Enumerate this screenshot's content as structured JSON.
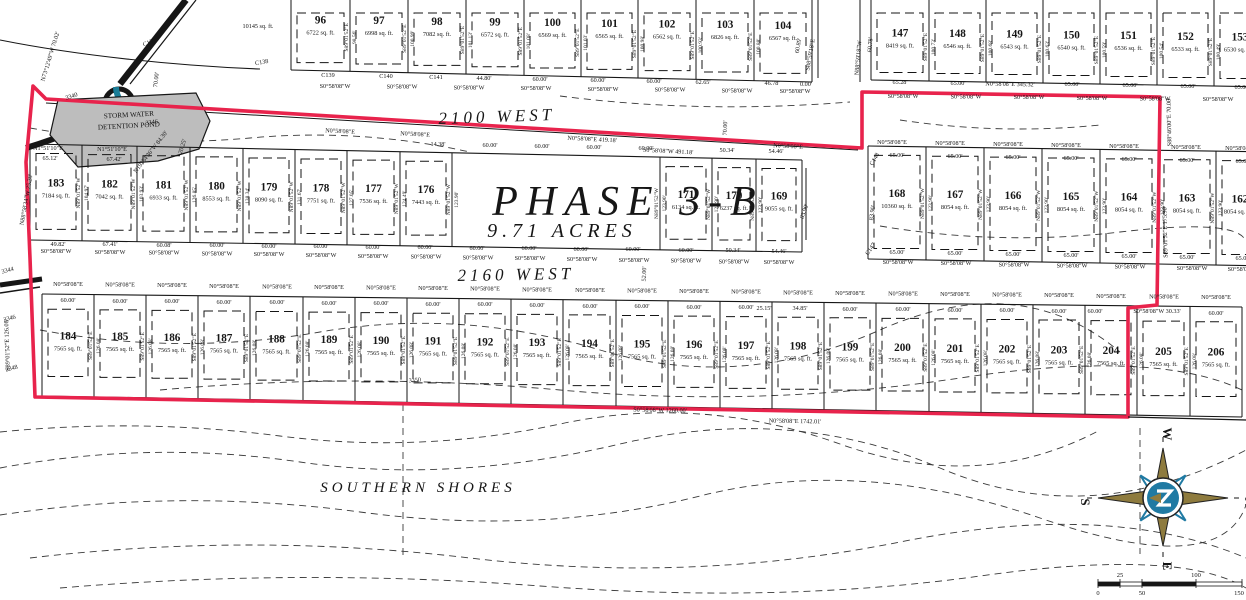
{
  "meta": {
    "width": 1246,
    "height": 600
  },
  "colors": {
    "paper": "#ffffff",
    "ink": "#161616",
    "boundary_red": "#e8234c",
    "pond_gray": "#bdbdbd",
    "teal": "#1b7d97",
    "compass_gold": "#8e7b3e",
    "compass_blue": "#1f7aa3"
  },
  "title": {
    "phase": "PHASE 3-B",
    "acres": "9.71 ACRES"
  },
  "streets": [
    {
      "name": "2100 WEST",
      "x": 497,
      "y": 122,
      "size": 17,
      "rot": -2
    },
    {
      "name": "2160 WEST",
      "x": 516,
      "y": 280,
      "size": 17,
      "rot": -1
    },
    {
      "name": "SOUTHERN SHORES",
      "x": 418,
      "y": 492,
      "size": 15,
      "rot": 0
    }
  ],
  "pond": {
    "line1": "STORM WATER",
    "line2": "DETENTION POND"
  },
  "compass": {
    "top": "W",
    "right": "N",
    "bottom": "E",
    "left": "S"
  },
  "scale_bar": {
    "top_labels": [
      {
        "t": "25",
        "x": 1120
      },
      {
        "t": "100",
        "x": 1196
      }
    ],
    "bottom_labels": [
      {
        "t": "0",
        "x": 1098
      },
      {
        "t": "50",
        "x": 1142
      },
      {
        "t": "150",
        "x": 1239
      }
    ]
  },
  "boundary": {
    "points": [
      [
        33,
        86
      ],
      [
        46,
        99
      ],
      [
        862,
        148
      ],
      [
        862,
        92
      ],
      [
        1160,
        97
      ],
      [
        1157,
        305
      ],
      [
        1128,
        308
      ],
      [
        1128,
        417
      ],
      [
        35,
        397
      ],
      [
        30,
        258
      ],
      [
        26,
        162
      ],
      [
        33,
        86
      ]
    ]
  },
  "strips": [
    {
      "id": "block-96-104",
      "cut_top": true,
      "num_y": 23,
      "seps": [
        291,
        350,
        408,
        466,
        524,
        581,
        638,
        696,
        754,
        812
      ],
      "yt": [
        0,
        0
      ],
      "yb": [
        70,
        82
      ],
      "lots": [
        [
          "96",
          "6722 sq. ft."
        ],
        [
          "97",
          "6998 sq. ft."
        ],
        [
          "98",
          "7082 sq. ft."
        ],
        [
          "99",
          "6572 sq. ft."
        ],
        [
          "100",
          "6569 sq. ft."
        ],
        [
          "101",
          "6565 sq. ft."
        ],
        [
          "102",
          "6562 sq. ft."
        ],
        [
          "103",
          "6826 sq. ft."
        ],
        [
          "104",
          "6567 sq. ft."
        ]
      ],
      "bearing": "S89°01'52\"E",
      "depths": [
        "",
        "98.56'",
        "100.99'",
        "101.13'",
        "101.08'",
        "101.03'",
        "100.98'",
        "100.93'",
        "100.88'",
        ""
      ]
    },
    {
      "id": "block-147-153",
      "cut_top": true,
      "num_y": 36,
      "seps": [
        871,
        929,
        986,
        1043,
        1100,
        1157,
        1214,
        1271
      ],
      "yt": [
        0,
        0
      ],
      "yb": [
        80,
        87
      ],
      "lots": [
        [
          "147",
          "8419 sq. ft."
        ],
        [
          "148",
          "6546 sq. ft."
        ],
        [
          "149",
          "6543 sq. ft."
        ],
        [
          "150",
          "6540 sq. ft."
        ],
        [
          "151",
          "6536 sq. ft."
        ],
        [
          "152",
          "6533 sq. ft."
        ],
        [
          "153",
          "6530 sq. ft."
        ]
      ],
      "bearing": "S89°01'52\"E",
      "depths": [
        "",
        "100.73'",
        "100.68'",
        "100.63'",
        "100.59'",
        "100.54'",
        "100.49'",
        ""
      ]
    },
    {
      "id": "block-183-169",
      "seps": [
        30,
        82,
        137,
        190,
        243,
        295,
        347,
        400,
        452,
        504,
        556,
        608,
        660,
        712,
        756,
        802
      ],
      "yt": [
        144,
        160
      ],
      "yb": [
        240,
        252
      ],
      "skip_seps": [
        9,
        10,
        11
      ],
      "lots": [
        [
          "183",
          "7184 sq. ft."
        ],
        [
          "182",
          "7042 sq. ft."
        ],
        [
          "181",
          "6933 sq. ft."
        ],
        [
          "180",
          "8553 sq. ft."
        ],
        [
          "179",
          "8090 sq. ft."
        ],
        [
          "178",
          "7751 sq. ft."
        ],
        [
          "177",
          "7536 sq. ft."
        ],
        [
          "176",
          "7443 sq. ft."
        ],
        [
          "175",
          null
        ],
        [
          "174",
          null
        ],
        [
          "173",
          null
        ],
        [
          "172",
          null
        ],
        [
          "171",
          "6134 sq. ft."
        ],
        [
          "170",
          "6237 sq. ft."
        ],
        [
          "169",
          "9055 sq. ft."
        ]
      ],
      "bearing": "N89°01'52\"W",
      "depths": [
        "",
        "104.97'",
        "103.93'",
        "126.85'",
        "138.34'",
        "131.67'",
        "127.05'",
        "124.49'",
        "123.90'",
        "",
        "",
        "",
        "123.90'",
        "123.90'",
        "123.90'",
        ""
      ]
    },
    {
      "id": "block-168-162",
      "seps": [
        868,
        926,
        984,
        1042,
        1100,
        1158,
        1216,
        1274
      ],
      "yt": [
        146,
        152
      ],
      "yb": [
        259,
        266
      ],
      "lots": [
        [
          "168",
          "10360 sq. ft."
        ],
        [
          "167",
          "8054 sq. ft."
        ],
        [
          "166",
          "8054 sq. ft."
        ],
        [
          "165",
          "8054 sq. ft."
        ],
        [
          "164",
          "8054 sq. ft."
        ],
        [
          "163",
          "8054 sq. ft."
        ],
        [
          "162",
          "8054 sq. ft."
        ]
      ],
      "bearing": "N89°01'52\"W",
      "depths": [
        "",
        "123.90'",
        "123.90'",
        "123.90'",
        "123.90'",
        "123.90'",
        "123.90'",
        ""
      ]
    },
    {
      "id": "block-184-206",
      "dash_inset": [
        15,
        20
      ],
      "seps": [
        42,
        94,
        146,
        198,
        250,
        303,
        355,
        407,
        459,
        511,
        563,
        616,
        668,
        720,
        772,
        824,
        876,
        929,
        981,
        1033,
        1085,
        1137,
        1190,
        1242
      ],
      "yt": [
        294,
        307
      ],
      "yb": [
        396,
        417
      ],
      "lots": [
        [
          "184",
          "7565 sq. ft."
        ],
        [
          "185",
          "7565 sq. ft."
        ],
        [
          "186",
          "7565 sq. ft."
        ],
        [
          "187",
          "7565 sq. ft."
        ],
        [
          "188",
          "7565 sq. ft."
        ],
        [
          "189",
          "7565 sq. ft."
        ],
        [
          "190",
          "7565 sq. ft."
        ],
        [
          "191",
          "7565 sq. ft."
        ],
        [
          "192",
          "7565 sq. ft."
        ],
        [
          "193",
          "7565 sq. ft."
        ],
        [
          "194",
          "7565 sq. ft."
        ],
        [
          "195",
          "7565 sq. ft."
        ],
        [
          "196",
          "7565 sq. ft."
        ],
        [
          "197",
          "7565 sq. ft."
        ],
        [
          "198",
          "7565 sq. ft."
        ],
        [
          "199",
          "7565 sq. ft."
        ],
        [
          "200",
          "7565 sq. ft."
        ],
        [
          "201",
          "7565 sq. ft."
        ],
        [
          "202",
          "7565 sq. ft."
        ],
        [
          "203",
          "7565 sq. ft."
        ],
        [
          "204",
          "7565 sq. ft."
        ],
        [
          "205",
          "7565 sq. ft."
        ],
        [
          "206",
          "7565 sq. ft."
        ]
      ],
      "bearing": "S89°01'52\"E",
      "depths": [
        "",
        "126.08'",
        "126.08'",
        "126.08'",
        "126.08'",
        "126.08'",
        "126.08'",
        "126.08'",
        "126.08'",
        "126.08'",
        "126.08'",
        "126.08'",
        "126.08'",
        "126.08'",
        "126.08'",
        "126.08'",
        "126.08'",
        "126.08'",
        "126.08'",
        "126.08'",
        "126.08'",
        "126.08'",
        "126.08'",
        ""
      ]
    }
  ],
  "bearing_rows": [
    {
      "t": "S0°58'08\"W",
      "y1": 88,
      "y2": 93,
      "xs": [
        335,
        402,
        469,
        536,
        603,
        670,
        737,
        795
      ]
    },
    {
      "t": "S0°58'08\"W",
      "y1": 98,
      "y2": 101,
      "xs": [
        903,
        966,
        1029,
        1092,
        1155,
        1218
      ]
    },
    {
      "t": "N0°58'08\"E",
      "y1": 144,
      "y2": 150,
      "xs": [
        892,
        950,
        1008,
        1066,
        1124,
        1186,
        1240
      ]
    },
    {
      "t": "S0°58'08\"W",
      "y1": 253,
      "y2": 264,
      "xs": [
        56,
        110,
        164,
        217,
        269,
        321,
        373,
        426,
        478,
        530,
        582,
        634,
        686,
        734,
        779
      ]
    },
    {
      "t": "S0°58'08\"W",
      "y1": 264,
      "y2": 271,
      "xs": [
        898,
        956,
        1014,
        1072,
        1130,
        1192,
        1243
      ]
    },
    {
      "t": "N0°58'08\"E",
      "y1": 286,
      "y2": 299,
      "xs": [
        68,
        120,
        172,
        224,
        277,
        329,
        381,
        433,
        485,
        537,
        590,
        642,
        694,
        746,
        798,
        850,
        903,
        955,
        1007,
        1059,
        1111,
        1164,
        1216
      ]
    }
  ],
  "dims": [
    [
      "C139",
      328,
      77
    ],
    [
      "C140",
      386,
      78
    ],
    [
      "C141",
      436,
      79
    ],
    [
      "44.80'",
      484,
      80
    ],
    [
      "60.00'",
      540,
      81
    ],
    [
      "60.00'",
      598,
      82
    ],
    [
      "60.00'",
      654,
      83
    ],
    [
      "62.65'",
      703,
      84
    ],
    [
      "46.78'",
      772,
      85
    ],
    [
      "0.00'",
      806,
      86
    ],
    [
      "65.28'",
      900,
      84
    ],
    [
      "65.00'",
      958,
      85
    ],
    [
      "65.00'",
      1072,
      86
    ],
    [
      "65.00'",
      1130,
      87
    ],
    [
      "65.00'",
      1188,
      88
    ],
    [
      "65.00'",
      1242,
      89
    ],
    [
      "14.38'",
      438,
      146
    ],
    [
      "60.00'",
      490,
      147
    ],
    [
      "60.00'",
      542,
      148
    ],
    [
      "60.00'",
      594,
      149
    ],
    [
      "60.00'",
      646,
      150
    ],
    [
      "50.34'",
      727,
      152
    ],
    [
      "54.46'",
      776,
      153
    ],
    [
      "65.00'",
      897,
      157
    ],
    [
      "65.00'",
      955,
      158
    ],
    [
      "65.00'",
      1013,
      159
    ],
    [
      "65.00'",
      1071,
      160
    ],
    [
      "65.00'",
      1129,
      161
    ],
    [
      "65.00'",
      1187,
      162
    ],
    [
      "65.00'",
      1243,
      163
    ],
    [
      "49.82'",
      58,
      246
    ],
    [
      "67.41'",
      110,
      246
    ],
    [
      "60.08'",
      164,
      247
    ],
    [
      "60.00'",
      217,
      247
    ],
    [
      "60.00'",
      269,
      248
    ],
    [
      "60.00'",
      321,
      248
    ],
    [
      "60.00'",
      373,
      249
    ],
    [
      "60.00'",
      425,
      249
    ],
    [
      "60.00'",
      477,
      250
    ],
    [
      "60.00'",
      529,
      250
    ],
    [
      "60.00'",
      581,
      251
    ],
    [
      "60.00'",
      633,
      251
    ],
    [
      "60.00'",
      686,
      252
    ],
    [
      "50.34'",
      733,
      252
    ],
    [
      "54.46'",
      779,
      253
    ],
    [
      "65.00'",
      897,
      254
    ],
    [
      "65.00'",
      955,
      255
    ],
    [
      "65.00'",
      1013,
      256
    ],
    [
      "65.00'",
      1071,
      257
    ],
    [
      "65.00'",
      1129,
      258
    ],
    [
      "65.00'",
      1187,
      259
    ],
    [
      "65.00'",
      1243,
      260
    ],
    [
      "60.00'",
      68,
      302
    ],
    [
      "60.00'",
      120,
      303
    ],
    [
      "60.00'",
      172,
      303
    ],
    [
      "60.00'",
      224,
      304
    ],
    [
      "60.00'",
      277,
      304
    ],
    [
      "60.00'",
      329,
      305
    ],
    [
      "60.00'",
      381,
      305
    ],
    [
      "60.00'",
      433,
      306
    ],
    [
      "60.00'",
      485,
      306
    ],
    [
      "60.00'",
      537,
      307
    ],
    [
      "60.00'",
      590,
      308
    ],
    [
      "60.00'",
      642,
      308
    ],
    [
      "60.00'",
      694,
      309
    ],
    [
      "60.00'",
      746,
      309
    ],
    [
      "25.15'",
      764,
      310
    ],
    [
      "34.85'",
      800,
      310
    ],
    [
      "60.00'",
      850,
      311
    ],
    [
      "60.00'",
      903,
      311
    ],
    [
      "60.00'",
      955,
      312
    ],
    [
      "60.00'",
      1007,
      312
    ],
    [
      "60.00'",
      1059,
      313
    ],
    [
      "60.00'",
      1095,
      313
    ],
    [
      "60.00'",
      1216,
      315
    ]
  ],
  "labels": [
    {
      "t": "10145 sq. ft.",
      "x": 258,
      "y": 28,
      "r": 0
    },
    {
      "t": "N0°58'08\"E",
      "x": 340,
      "y": 133,
      "r": 3
    },
    {
      "t": "N0°58'08\"E",
      "x": 415,
      "y": 136,
      "r": 3
    },
    {
      "t": "N0°58'08\"E 419.18'",
      "x": 592,
      "y": 141,
      "r": 3
    },
    {
      "t": "S0°58'08\"W 491.18'",
      "x": 668,
      "y": 153,
      "r": 3
    },
    {
      "t": "N0°58'08\"E",
      "x": 788,
      "y": 148,
      "r": 3
    },
    {
      "t": "N0°58'08\"E 345.32'",
      "x": 1010,
      "y": 86,
      "r": 1
    },
    {
      "t": "S0°58'08\"W 1260.00'",
      "x": 660,
      "y": 412,
      "r": 1
    },
    {
      "t": "N0°58'08\"E 1742.01'",
      "x": 795,
      "y": 423,
      "r": 1
    },
    {
      "t": "S0°58'08\"W 30.33'",
      "x": 1157,
      "y": 313,
      "r": 0
    },
    {
      "t": "S89°01'52\"E 126.08'",
      "x": 9,
      "y": 345,
      "r": -92
    },
    {
      "t": "N88°58'34\"W 25.28'",
      "x": 28,
      "y": 200,
      "r": -80
    },
    {
      "t": "N1°51'10\"E",
      "x": 48,
      "y": 150,
      "r": 0
    },
    {
      "t": "65.12'",
      "x": 50,
      "y": 160,
      "r": 0
    },
    {
      "t": "N1°51'10\"E",
      "x": 112,
      "y": 151,
      "r": 0
    },
    {
      "t": "67.42'",
      "x": 114,
      "y": 161,
      "r": 0
    },
    {
      "t": "N19°54'36\"W 84.30'",
      "x": 152,
      "y": 153,
      "r": -52
    },
    {
      "t": "20.25'",
      "x": 184,
      "y": 147,
      "r": -72
    },
    {
      "t": "N73°12'49\"W 70.02'",
      "x": 52,
      "y": 57,
      "r": -73
    },
    {
      "t": "70.00'",
      "x": 158,
      "y": 80,
      "r": -83
    },
    {
      "t": "70.00'",
      "x": 727,
      "y": 128,
      "r": -88
    },
    {
      "t": "52.00'",
      "x": 646,
      "y": 274,
      "r": -88
    },
    {
      "t": "S88°46'00\"E 70.00'",
      "x": 1171,
      "y": 122,
      "r": -91
    },
    {
      "t": "S89°01'52\"E 175.90'",
      "x": 1167,
      "y": 232,
      "r": -91
    },
    {
      "t": "60.89'",
      "x": 800,
      "y": 46,
      "r": -80
    },
    {
      "t": "S88°59'18\"E",
      "x": 812,
      "y": 55,
      "r": -80
    },
    {
      "t": "60.78'",
      "x": 872,
      "y": 45,
      "r": -85
    },
    {
      "t": "N88°59'18\"W",
      "x": 860,
      "y": 58,
      "r": -85
    },
    {
      "t": "83.90'",
      "x": 806,
      "y": 212,
      "r": -70
    },
    {
      "t": "83.90'",
      "x": 874,
      "y": 213,
      "r": -82
    },
    {
      "t": "C137",
      "x": 150,
      "y": 44,
      "r": -22
    },
    {
      "t": "C138",
      "x": 262,
      "y": 64,
      "r": -10
    },
    {
      "t": "C148",
      "x": 876,
      "y": 160,
      "r": -60
    },
    {
      "t": "C147",
      "x": 872,
      "y": 250,
      "r": -55
    },
    {
      "t": "3340",
      "x": 72,
      "y": 98,
      "r": -18
    },
    {
      "t": "3346",
      "x": 152,
      "y": 124,
      "r": -8
    },
    {
      "t": "3344",
      "x": 8,
      "y": 272,
      "r": -15
    },
    {
      "t": "3346",
      "x": 10,
      "y": 320,
      "r": -15
    },
    {
      "t": "3348",
      "x": 12,
      "y": 370,
      "r": -15
    },
    {
      "t": "3350",
      "x": 415,
      "y": 382,
      "r": -5
    }
  ]
}
